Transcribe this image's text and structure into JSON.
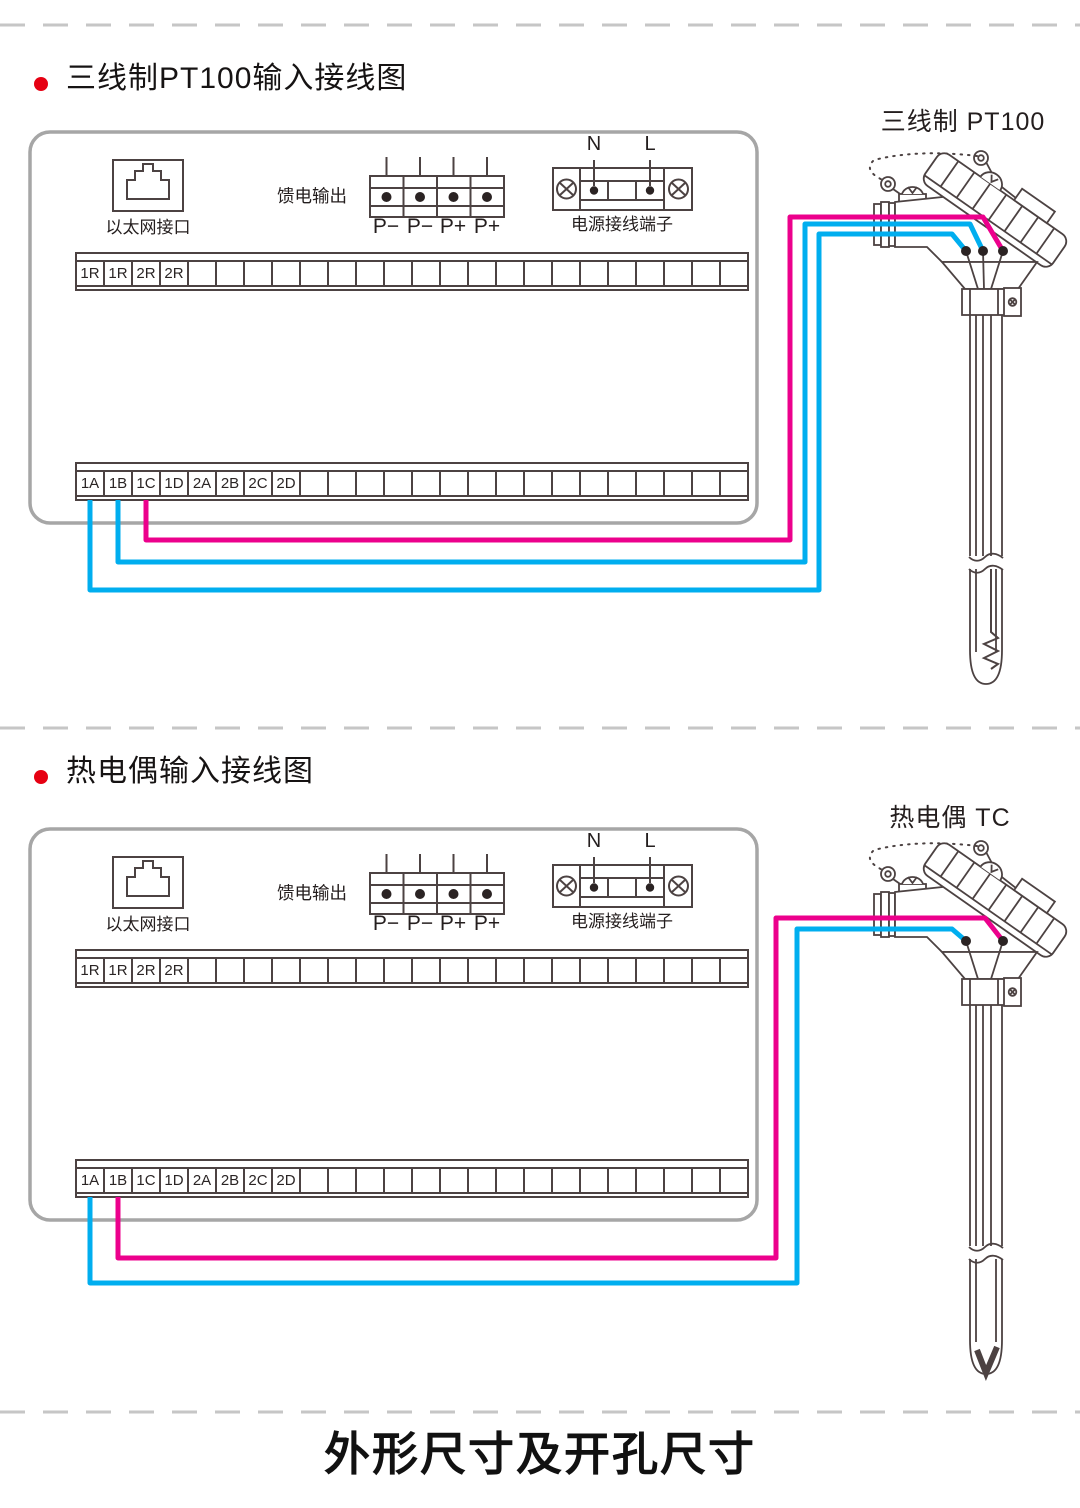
{
  "colors": {
    "ink": "#4c4242",
    "panel": "#a6a6a6",
    "dash": "#c6c6c6",
    "red": "#e60012",
    "cyan": "#00aeef",
    "magenta": "#ec008c",
    "dot": "#2b2323"
  },
  "sections": [
    {
      "title": "三线制PT100输入接线图",
      "sensor_label": "三线制 PT100",
      "sensor_type": "3-wire RTD PT100",
      "device": {
        "ethernet_label": "以太网接口",
        "feed_output_label": "馈电输出",
        "feed_terminal_labels": [
          "P−",
          "P−",
          "P+",
          "P+"
        ],
        "power_block_label": "电源接线端子",
        "power_terminal_labels": [
          "N",
          "L"
        ],
        "relay_row_labels": [
          "1R",
          "1R",
          "2R",
          "2R"
        ],
        "input_row_labels": [
          "1A",
          "1B",
          "1C",
          "1D",
          "2A",
          "2B",
          "2C",
          "2D"
        ],
        "cells_total": 24
      },
      "wiring": [
        {
          "terminal": "1A",
          "wire_color": "cyan"
        },
        {
          "terminal": "1B",
          "wire_color": "cyan"
        },
        {
          "terminal": "1C",
          "wire_color": "magenta"
        }
      ]
    },
    {
      "title": "热电偶输入接线图",
      "sensor_label": "热电偶 TC",
      "sensor_type": "Thermocouple TC",
      "device": {
        "ethernet_label": "以太网接口",
        "feed_output_label": "馈电输出",
        "feed_terminal_labels": [
          "P−",
          "P−",
          "P+",
          "P+"
        ],
        "power_block_label": "电源接线端子",
        "power_terminal_labels": [
          "N",
          "L"
        ],
        "relay_row_labels": [
          "1R",
          "1R",
          "2R",
          "2R"
        ],
        "input_row_labels": [
          "1A",
          "1B",
          "1C",
          "1D",
          "2A",
          "2B",
          "2C",
          "2D"
        ],
        "cells_total": 24
      },
      "wiring": [
        {
          "terminal": "1A",
          "wire_color": "cyan"
        },
        {
          "terminal": "1B",
          "wire_color": "magenta"
        }
      ]
    }
  ],
  "footer_heading": "外形尺寸及开孔尺寸"
}
